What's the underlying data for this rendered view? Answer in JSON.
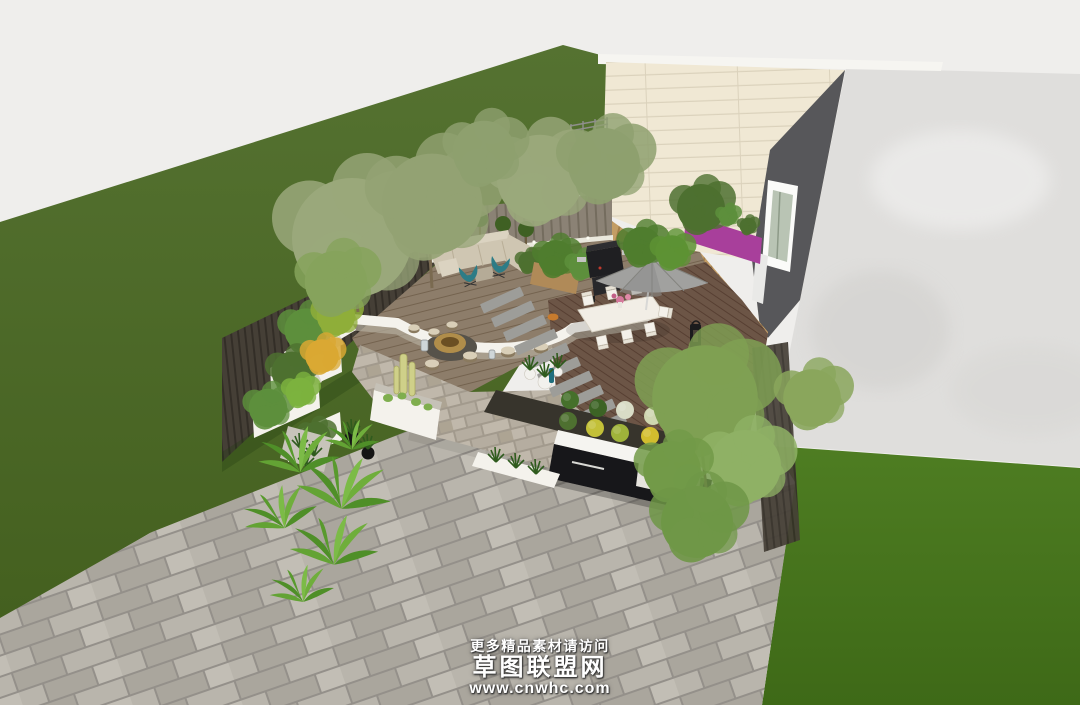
{
  "watermark": {
    "notice": "更多精品素材请访问",
    "site_name": "草图联盟网",
    "site_url": "www.cnwhc.com"
  },
  "scene": {
    "title": "courtyard-garden-3d-render",
    "objects": [
      "back lawn",
      "front lawn",
      "concrete boundary wall",
      "cream panel house",
      "dark gable wing",
      "wood clad lower storey",
      "magenta balcony",
      "rooftop cabin",
      "picket fence",
      "dark privacy fence",
      "lounge deck with sofa",
      "teal butterfly chairs",
      "bbq grill",
      "dining deck with table and chairs",
      "patio umbrella",
      "fire pit plaza",
      "log stools",
      "stepping stone path",
      "white planter boxes",
      "cactus planter",
      "shrub ball bed",
      "black outdoor kitchen",
      "paver patio",
      "tropical plants",
      "trees"
    ],
    "colors": {
      "sky": "#efeeec",
      "lawn_back": "#557231",
      "lawn_back_dark": "#44601f",
      "lawn_front": "#4e7d22",
      "lawn_front_dark": "#3e6917",
      "concrete_wall": "#dfdedc",
      "house_cream": "#f0e8d4",
      "house_cream_line": "#dbd2bc",
      "house_dark": "#57575a",
      "wood_cladding": "#c39d65",
      "wood_cladding_line": "#a37f4b",
      "accent_magenta": "#a83f9b",
      "white_trim": "#f6f5f1",
      "fence_picket": "#8b8275",
      "fence_picket_slat": "#746c5e",
      "fence_dark": "#453f36",
      "fence_dark_slat": "#332e27",
      "deck_lounge": "#8d7d6a",
      "deck_lounge_line": "#74634f",
      "deck_dining": "#6c5546",
      "deck_dining_line": "#573f32",
      "deck_step": "#7d6b57",
      "paver_patio": "#aaa69d",
      "paver_patio_alt": "#b9b5ac",
      "paver_patio_dark": "#94908a",
      "paver_warm": "#b5ada0",
      "paver_warm_alt": "#c0b8ab",
      "stone_plank": "#9d9d99",
      "white_wall": "#f4f2ec",
      "soil_dark": "#37342c",
      "kitchen_black": "#17171a",
      "counter_white": "#f5f4f0",
      "sofa_beige": "#cfc6b2",
      "cushion_beige": "#dbd3c1",
      "chair_teal": "#2d7c86",
      "umbrella_gray": "#a1a19f",
      "umbrella_gray_dark": "#8c8c8a",
      "grill_black": "#1f1f22",
      "fire_bronze": "#b08d4a",
      "fire_pad": "#56524a",
      "foliage_olive": "#9aa87b",
      "foliage_green": "#6f9747",
      "foliage_feather": "#7fa053",
      "foliage_tropical": "#55982c",
      "foliage_tropical_light": "#73b23e",
      "foliage_dark": "#3f6526",
      "shrub_green": "#45702b",
      "shrub_yellow": "#c3c038",
      "shrub_white": "#d9dcc6",
      "shrub_gold": "#d2bd2e",
      "watermark_white": "#ffffff"
    }
  }
}
